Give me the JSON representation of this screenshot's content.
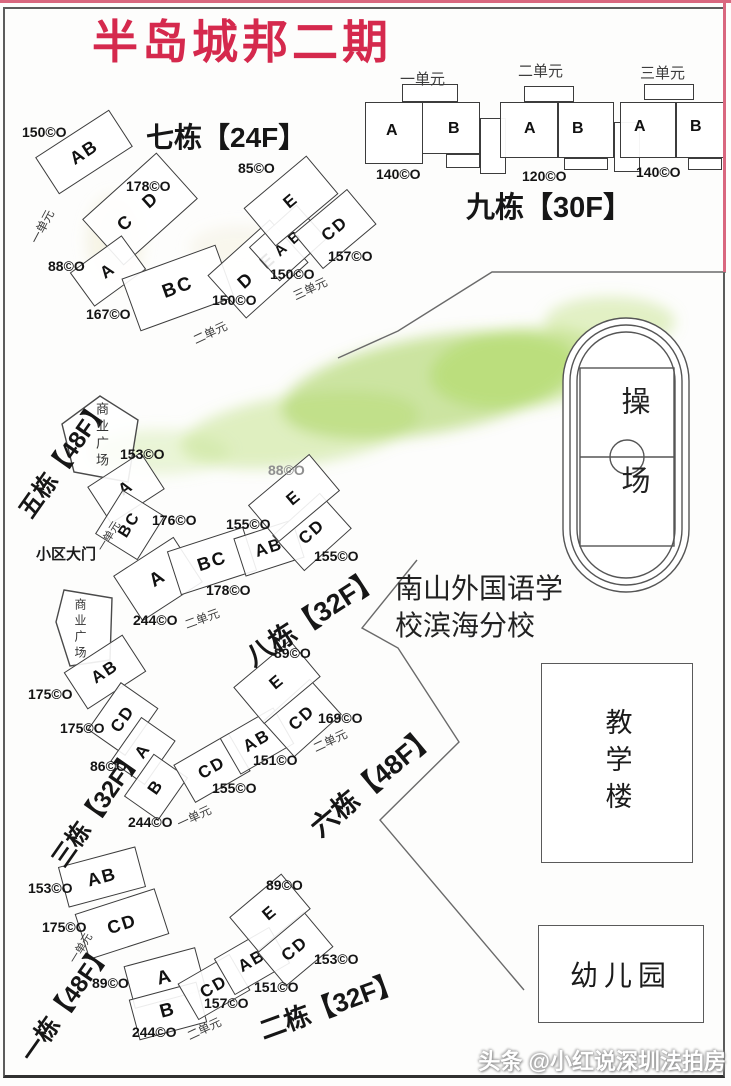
{
  "title": "半岛城邦二期",
  "watermark": "头条 @小红说深圳法拍房",
  "labels": {
    "plaza": "商业广场",
    "gate": "小区大门"
  },
  "school": {
    "name_line1": "南山外国语学",
    "name_line2": "校滨海分校",
    "playground": "操场",
    "teaching": "教学楼",
    "kindergarten": "幼儿园"
  },
  "colors": {
    "title_red": "#d5294d",
    "border_pink": "#d9677f",
    "green_patch": "#9ccb45"
  },
  "b9": {
    "name": "九栋【30F】",
    "units": [
      "一单元",
      "二单元",
      "三单元"
    ],
    "pairs": [
      {
        "a": "A",
        "b": "B",
        "area": "140©O"
      },
      {
        "a": "A",
        "b": "B",
        "area": "120©O"
      },
      {
        "a": "A",
        "b": "B",
        "area": "140©O"
      }
    ]
  },
  "b7": {
    "name": "七栋【24F】",
    "units": [
      "一单元",
      "二单元",
      "三单元"
    ],
    "blocks": [
      {
        "letters": "AB",
        "area": "150©O"
      },
      {
        "letters": "C D",
        "area": "178©O"
      },
      {
        "letters": "A",
        "area": "88©O"
      },
      {
        "letters": "BC",
        "area": "167©O"
      },
      {
        "letters": "D E",
        "area": "150©O"
      },
      {
        "letters": "A B",
        "area": "150©O"
      },
      {
        "letters": "CD",
        "area": "157©O"
      },
      {
        "letters": "E",
        "area": "85©O"
      }
    ]
  },
  "b5": {
    "name": "五栋【48F】",
    "unit": "一单元",
    "blocks": [
      {
        "letters": "A",
        "area": "153©O"
      },
      {
        "letters": "BC",
        "area": "176©O"
      }
    ]
  },
  "b8": {
    "name": "八栋【32F】",
    "unit": "二单元",
    "blocks": [
      {
        "letters": "A",
        "area": "244©O"
      },
      {
        "letters": "BC",
        "area": "178©O"
      },
      {
        "letters": "AB",
        "area": "155©O"
      },
      {
        "letters": "CD",
        "area": "155©O"
      },
      {
        "letters": "E",
        "area": "88©O"
      }
    ]
  },
  "b3": {
    "name": "三栋【32F】",
    "unit": "一单元",
    "blocks": [
      {
        "letters": "AB",
        "area": "175©O"
      },
      {
        "letters": "CD",
        "area": "175©O"
      },
      {
        "letters": "A",
        "area": "86©O"
      },
      {
        "letters": "B",
        "area": "244©O"
      }
    ]
  },
  "b6": {
    "name": "六栋【48F】",
    "unit": "二单元",
    "blocks": [
      {
        "letters": "CD",
        "area": "155©O"
      },
      {
        "letters": "AB",
        "area": "151©O"
      },
      {
        "letters": "CD",
        "area": "169©O"
      },
      {
        "letters": "E",
        "area": "89©O"
      }
    ]
  },
  "b1": {
    "name": "一栋【48F】",
    "unit": "一单元",
    "blocks": [
      {
        "letters": "AB",
        "area": "153©O"
      },
      {
        "letters": "CD",
        "area": "175©O"
      },
      {
        "letters": "A",
        "area": "89©O"
      },
      {
        "letters": "B",
        "area": "244©O"
      }
    ]
  },
  "b2": {
    "name": "二栋【32F】",
    "unit": "二单元",
    "blocks": [
      {
        "letters": "CD",
        "area": "157©O"
      },
      {
        "letters": "AB",
        "area": "151©O"
      },
      {
        "letters": "CD",
        "area": "153©O"
      },
      {
        "letters": "E",
        "area": "89©O"
      }
    ]
  }
}
